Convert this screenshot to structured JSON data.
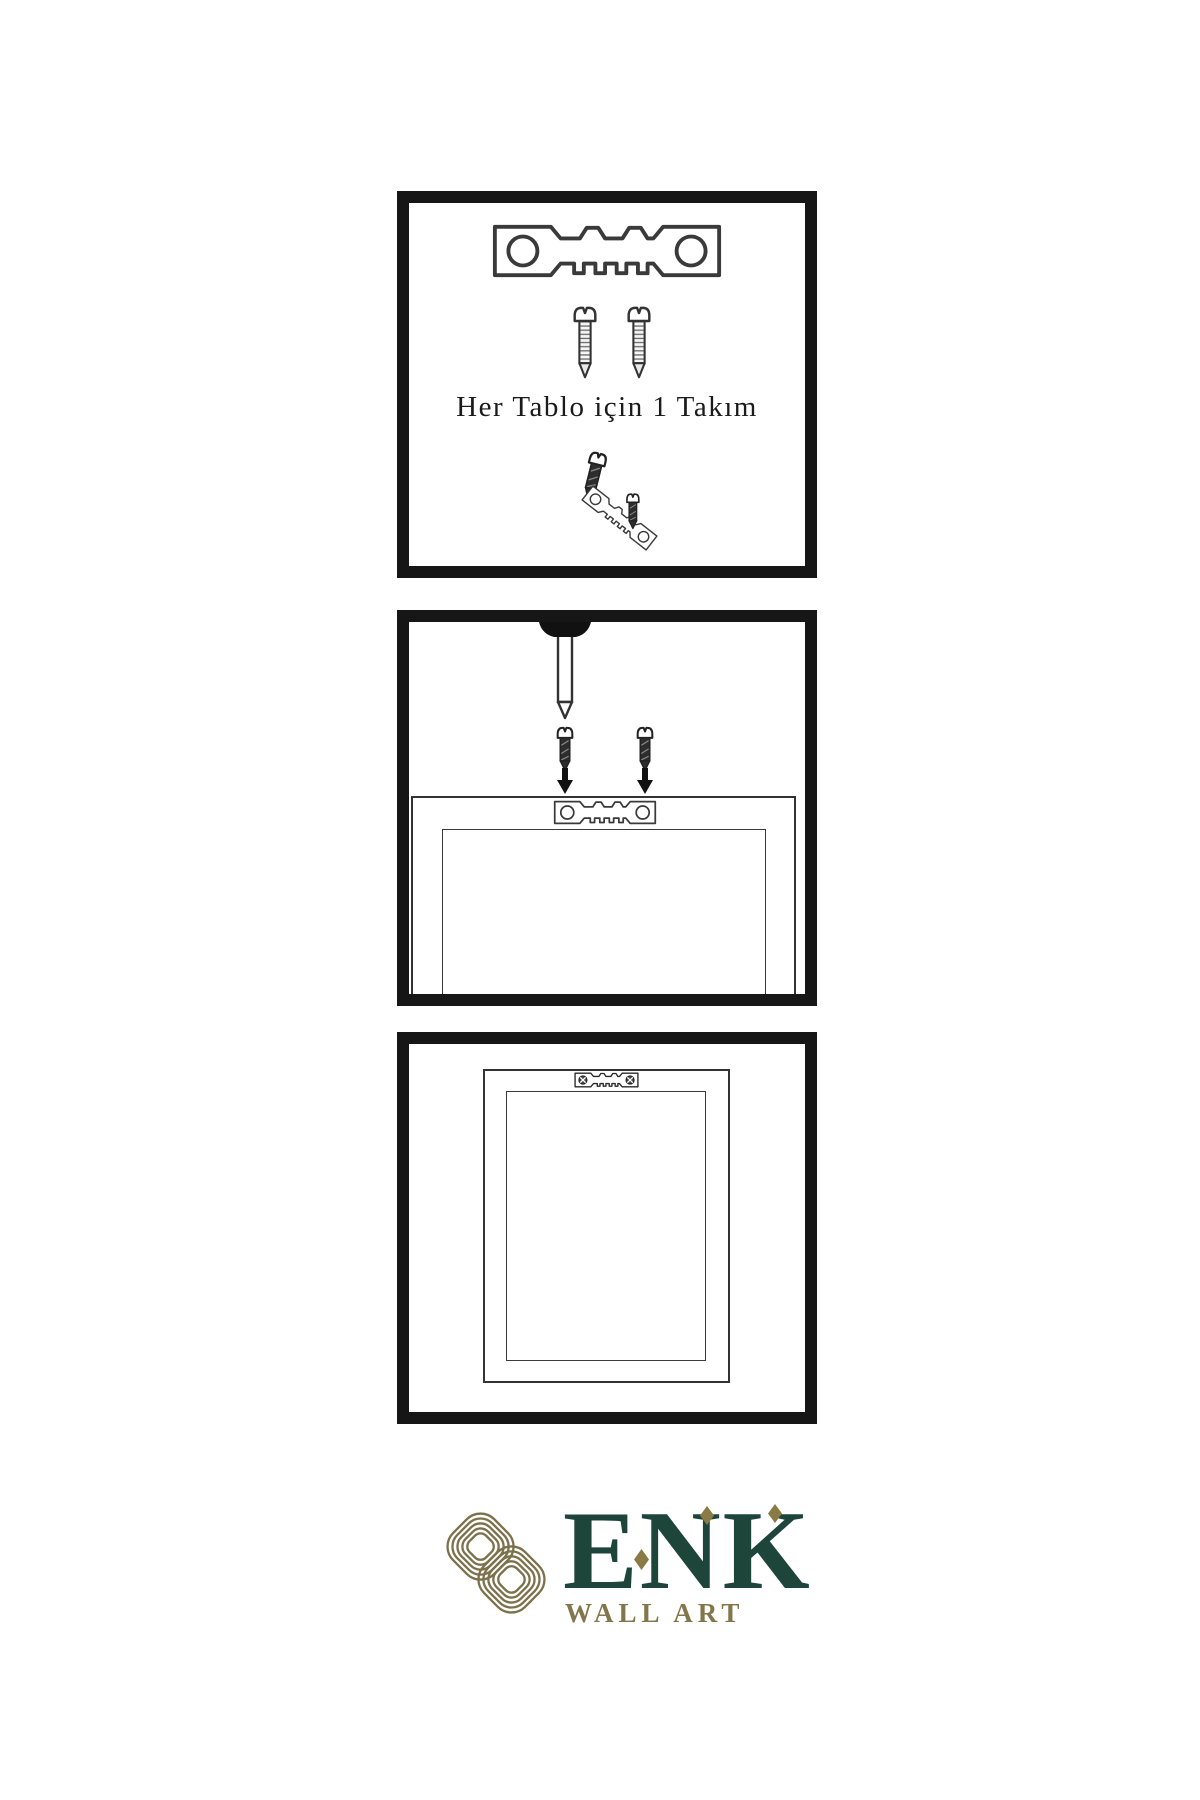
{
  "brand": {
    "name": "ENK",
    "subtitle": "WALL ART"
  },
  "panels": [
    {
      "id": "hardware-kit",
      "caption": "Her Tablo için 1 Takım",
      "contents": [
        "sawtooth-hanger-icon",
        "screw-icon",
        "screw-icon",
        "small-screw-icon",
        "angled-sawtooth-hanger-icon",
        "small-screw-icon"
      ]
    },
    {
      "id": "mounting-step",
      "caption": "",
      "contents": [
        "nail-icon",
        "small-screw-icon",
        "small-screw-icon",
        "arrow-down-icon",
        "arrow-down-icon",
        "frame-back-icon",
        "sawtooth-hanger-icon"
      ]
    },
    {
      "id": "hung-frame",
      "caption": "",
      "contents": [
        "frame-back-icon",
        "sawtooth-hanger-screwed-icon"
      ]
    }
  ],
  "icons": {
    "logo_mark": "knot-logo-icon",
    "hanger": "sawtooth-hanger-icon",
    "screw": "screw-icon",
    "nail": "nail-icon",
    "arrow": "arrow-down-icon"
  },
  "colors": {
    "background": "#ffffff",
    "panel_border": "#161616",
    "line": "#3a3a3a",
    "dark_metal": "#2d2d2d",
    "brand_green": "#1d4539",
    "brand_gold": "#84764c"
  }
}
